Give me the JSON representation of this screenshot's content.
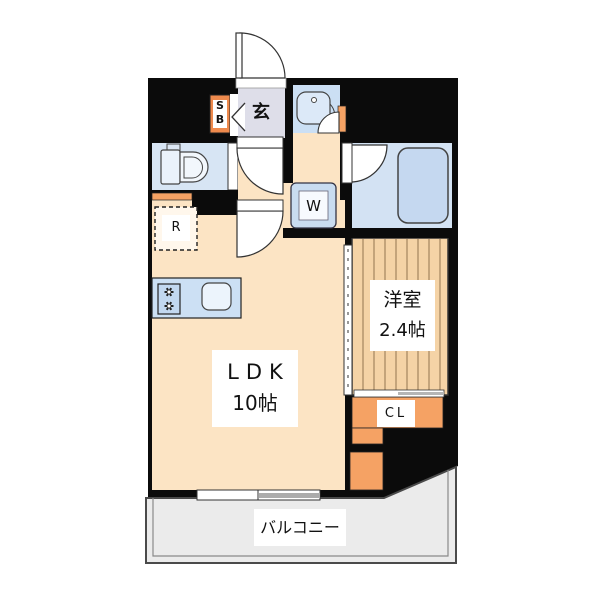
{
  "plan": {
    "type": "apartment-floor-plan",
    "rooms": {
      "entrance": {
        "label": "玄"
      },
      "shoe_box": {
        "line1": "S",
        "line2": "B"
      },
      "washer": {
        "label": "W"
      },
      "refrigerator": {
        "label": "R"
      },
      "ldk": {
        "name": "LDK",
        "size": "10帖"
      },
      "western_room": {
        "name": "洋室",
        "size": "2.4帖"
      },
      "closet": {
        "label": "CL"
      },
      "balcony": {
        "label": "バルコニー"
      }
    },
    "colors": {
      "wall_black": "#0b0b0b",
      "floor_cream": "#FCE4C4",
      "entrance_lavender": "#DEDEE9",
      "wet_area_blue": "#D5E3F3",
      "bathtub_blue": "#C5D8F0",
      "kitchen_blue": "#CCE0F4",
      "accent_orange": "#F5A264",
      "shoebox_orange": "#EE8A4D",
      "wood_floor": "#F5D3A6",
      "wood_stripe": "#A3855F",
      "balcony_gray": "#EBEBEB"
    }
  }
}
